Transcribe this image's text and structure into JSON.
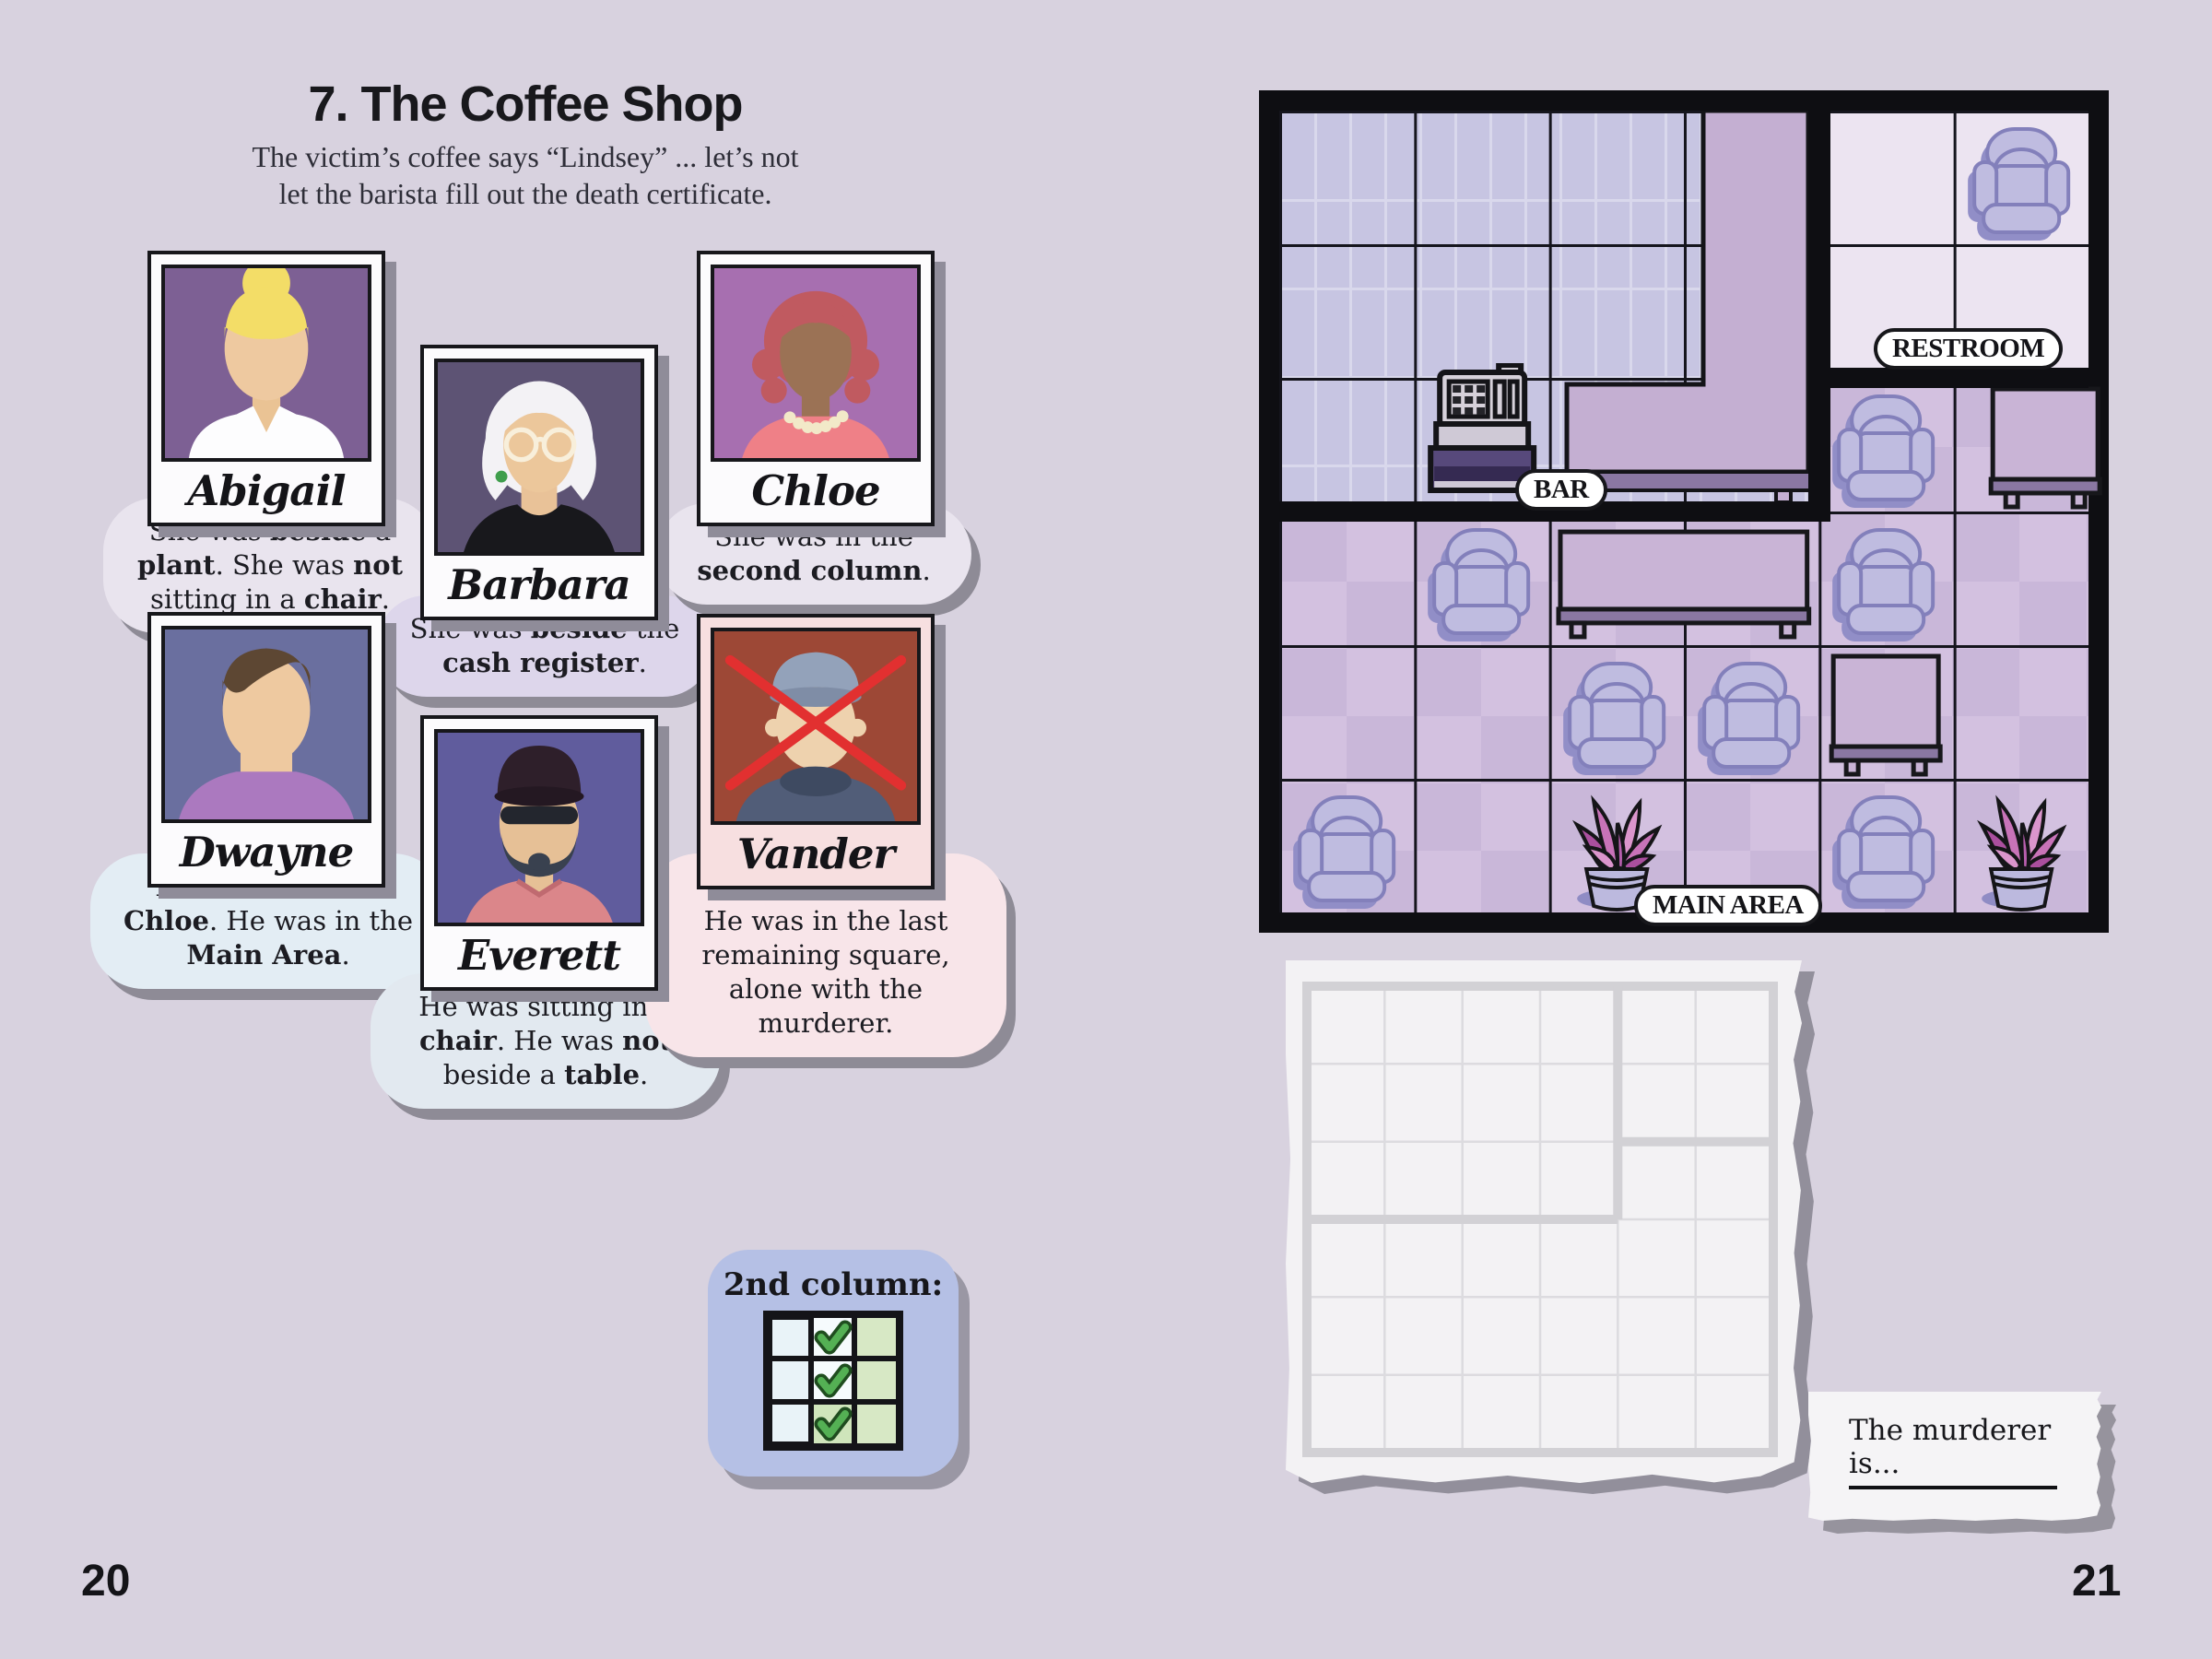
{
  "pages": {
    "left_number": "20",
    "right_number": "21"
  },
  "header": {
    "title": "7. The Coffee Shop",
    "subtitle_line1": "The victim’s coffee says “Lindsey” ... let’s not",
    "subtitle_line2": "let the barista fill out the death certificate."
  },
  "suspects": [
    {
      "name": "Abigail",
      "clue": [
        {
          "t": "She was "
        },
        {
          "t": "beside",
          "b": 1
        },
        {
          "t": " a "
        },
        {
          "t": "plant",
          "b": 1
        },
        {
          "t": ". She was "
        },
        {
          "t": "not",
          "b": 1
        },
        {
          "t": " sitting in a "
        },
        {
          "t": "chair",
          "b": 1
        },
        {
          "t": "."
        }
      ]
    },
    {
      "name": "Barbara",
      "clue": [
        {
          "t": "She was "
        },
        {
          "t": "beside",
          "b": 1
        },
        {
          "t": " the "
        },
        {
          "t": "cash register",
          "b": 1
        },
        {
          "t": "."
        }
      ]
    },
    {
      "name": "Chloe",
      "clue": [
        {
          "t": "She was in the "
        },
        {
          "t": "second column",
          "b": 1
        },
        {
          "t": "."
        }
      ]
    },
    {
      "name": "Dwayne",
      "clue": [
        {
          "t": "He was "
        },
        {
          "t": "north",
          "b": 1
        },
        {
          "t": " of "
        },
        {
          "t": "Chloe",
          "b": 1
        },
        {
          "t": ". He was in the "
        },
        {
          "t": "Main Area",
          "b": 1
        },
        {
          "t": "."
        }
      ]
    },
    {
      "name": "Everett",
      "clue": [
        {
          "t": "He was sitting in a "
        },
        {
          "t": "chair",
          "b": 1
        },
        {
          "t": ". He was "
        },
        {
          "t": "not",
          "b": 1
        },
        {
          "t": " beside a "
        },
        {
          "t": "table",
          "b": 1
        },
        {
          "t": "."
        }
      ]
    },
    {
      "name": "Vander",
      "victim": true,
      "clue": [
        {
          "t": "The Victim.",
          "b": 1
        },
        {
          "br": 1
        },
        {
          "t": "He was in the last remaining square, alone with the murderer."
        }
      ]
    }
  ],
  "hint": {
    "title": "2nd column:",
    "grid": {
      "rows": 3,
      "cols": 3,
      "checked_column": 2
    }
  },
  "map": {
    "labels": {
      "bar": "BAR",
      "restroom": "RESTROOM",
      "main_area": "MAIN AREA"
    },
    "grid": {
      "rows": 6,
      "cols": 6
    },
    "rooms": [
      {
        "name": "Bar",
        "cols": "1-4",
        "rows": "1-3"
      },
      {
        "name": "Restroom",
        "cols": "5-6",
        "rows": "1-2"
      },
      {
        "name": "Main Area",
        "cols": "1-6",
        "rows": "4-6 plus row 3 cols 5-6"
      }
    ],
    "objects": [
      {
        "type": "chair",
        "row": 1,
        "col": 6
      },
      {
        "type": "register",
        "row": 3,
        "col": 2
      },
      {
        "type": "chair",
        "row": 3,
        "col": 5
      },
      {
        "type": "table-right",
        "row": 3,
        "col": 6
      },
      {
        "type": "chair",
        "row": 4,
        "col": 2
      },
      {
        "type": "long-table",
        "row": 4,
        "col": 3,
        "colspan": 2
      },
      {
        "type": "chair",
        "row": 4,
        "col": 5
      },
      {
        "type": "chair",
        "row": 5,
        "col": 3
      },
      {
        "type": "chair",
        "row": 5,
        "col": 4
      },
      {
        "type": "table",
        "row": 5,
        "col": 5
      },
      {
        "type": "chair",
        "row": 6,
        "col": 1
      },
      {
        "type": "plant",
        "row": 6,
        "col": 3
      },
      {
        "type": "chair",
        "row": 6,
        "col": 5
      },
      {
        "type": "plant",
        "row": 6,
        "col": 6
      }
    ]
  },
  "worksheet": {
    "rows": 6,
    "cols": 6
  },
  "note": {
    "text": "The murderer is..."
  },
  "colors": {
    "background": "#d8d2df",
    "bar_floor": "#c7c5e2",
    "restroom_floor": "#ece4f1",
    "main_floor": "#c9b7d9",
    "victim_frame": "#f7dfe0",
    "check_green": "#54b054"
  }
}
